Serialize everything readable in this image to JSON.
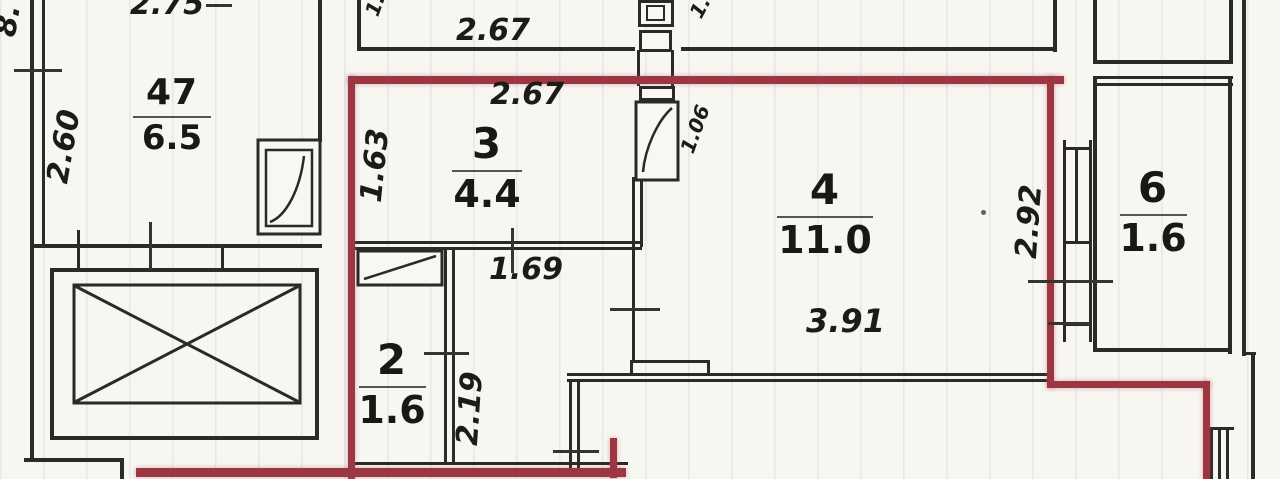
{
  "plan": {
    "rooms": [
      {
        "number": "47",
        "area": "6.5"
      },
      {
        "number": "3",
        "area": "4.4"
      },
      {
        "number": "2",
        "area": "1.6"
      },
      {
        "number": "4",
        "area": "11.0"
      },
      {
        "number": "6",
        "area": "1.6"
      }
    ],
    "dimensions": {
      "top_partial": "2.75",
      "left_top_partial": "8.",
      "room47_height": "2.60",
      "upper_room_width": "2.67",
      "room3_width": "2.67",
      "room3_height": "1.63",
      "room3_inner_width": "1.69",
      "door_width": "1.06",
      "room2_height": "2.19",
      "room4_width": "3.91",
      "room4_height": "2.92",
      "partial_1a": "1.",
      "partial_1b": "1."
    },
    "colors": {
      "apartment_outline": "#9c3742",
      "walls": "#2b2a26",
      "paper": "#f7f6f1"
    }
  }
}
